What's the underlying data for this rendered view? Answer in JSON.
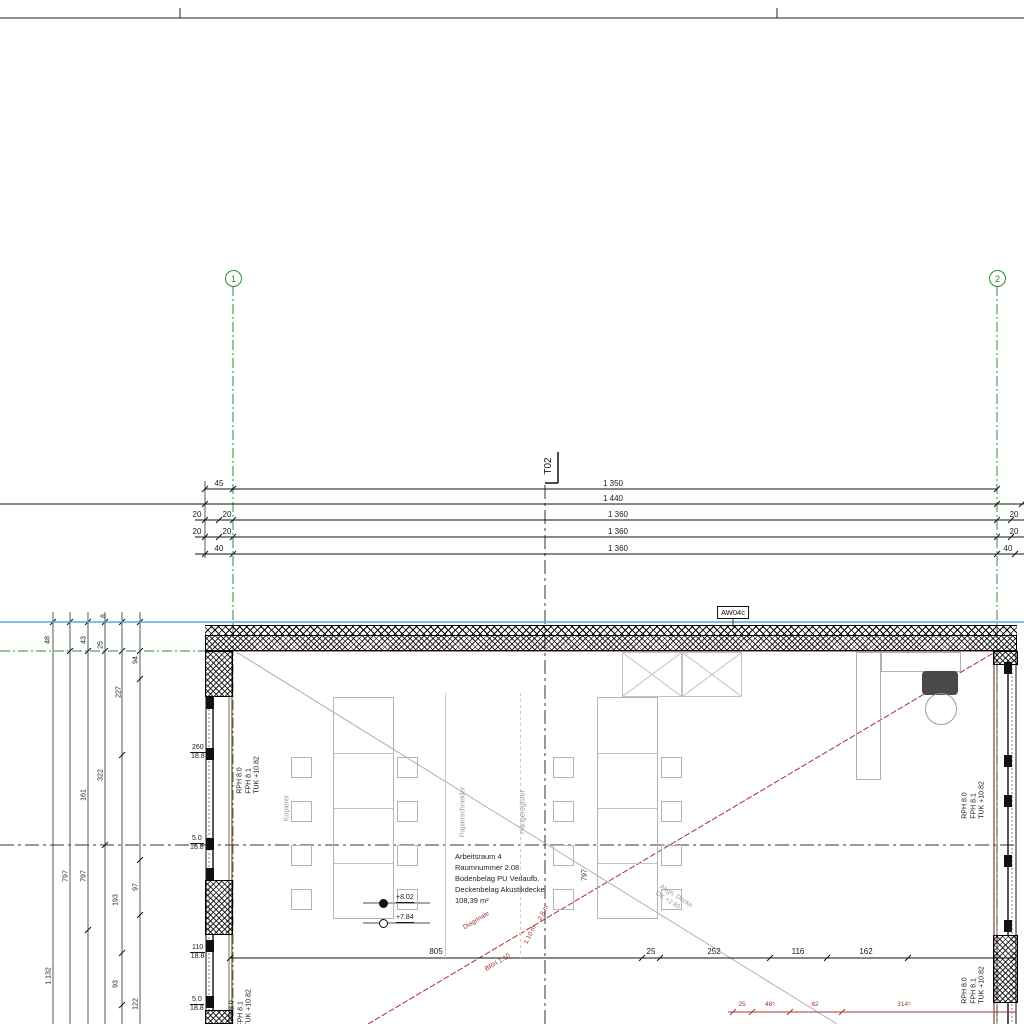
{
  "axes": {
    "a1": "1",
    "a2": "2"
  },
  "section": {
    "label": "T02"
  },
  "wall_tag": "AW04c",
  "dims_top": {
    "r1_left": "45",
    "r1_span": "1 350",
    "r2_span": "1 440",
    "r3_l1": "20",
    "r3_l2": "20",
    "r3_span": "1 360",
    "r3_r": "20",
    "r4_l1": "20",
    "r4_l2": "20",
    "r4_span": "1 360",
    "r4_r": "20",
    "r5_l": "40",
    "r5_span": "1 360",
    "r5_r": "40"
  },
  "chain_left": {
    "c48": "48",
    "c43": "43",
    "c25": "25",
    "c8": "8",
    "c94": "94",
    "c227": "227",
    "c322": "322",
    "c161": "161",
    "c797a": "797",
    "c797b": "797",
    "c193": "193",
    "c97": "97",
    "c1132": "1 132",
    "c93": "93",
    "c122": "122"
  },
  "wall_labels": {
    "line1": "RPH 8.0",
    "line2": "FPH 8.1",
    "line3": "TUK +10.82"
  },
  "wall_notes": [
    {
      "top": "260",
      "bottom": "18.8"
    },
    {
      "top": "5.0",
      "bottom": "18.8"
    },
    {
      "top": "110",
      "bottom": "18.8"
    },
    {
      "top": "5.0",
      "bottom": "18.8"
    }
  ],
  "room": {
    "line1": "Arbeitsraum 4",
    "line2": "Raumnummer 2.08",
    "line3": "Bodenbelag PU Verlaufb.",
    "line4": "Deckenbelag Akustikdecke",
    "line5": "108,39 m²",
    "interior_dim": "797"
  },
  "equipment": {
    "left": "Kopierer",
    "mid": "Papierschneider",
    "right": "Hängeregister"
  },
  "levels": {
    "upper": "+8.02",
    "lower": "+7.84"
  },
  "bottom_dims": [
    "805",
    "25",
    "252",
    "116",
    "162"
  ],
  "red": {
    "diag": "Diagonale",
    "m1": "2.8 m",
    "m2": "1.10 m",
    "note": "BRH 1.10",
    "dims": [
      "25",
      "48⁵",
      "82",
      "314⁵"
    ]
  },
  "ceiling_note": {
    "line1": "Abgh. Decke",
    "line2": "OK +2.80"
  },
  "colors": {
    "axis_green": "#2e8b2e",
    "frame_blue": "#58a8d7",
    "red": "#a83232",
    "gray": "#aaaaaa",
    "maroon": "#8b4040"
  }
}
